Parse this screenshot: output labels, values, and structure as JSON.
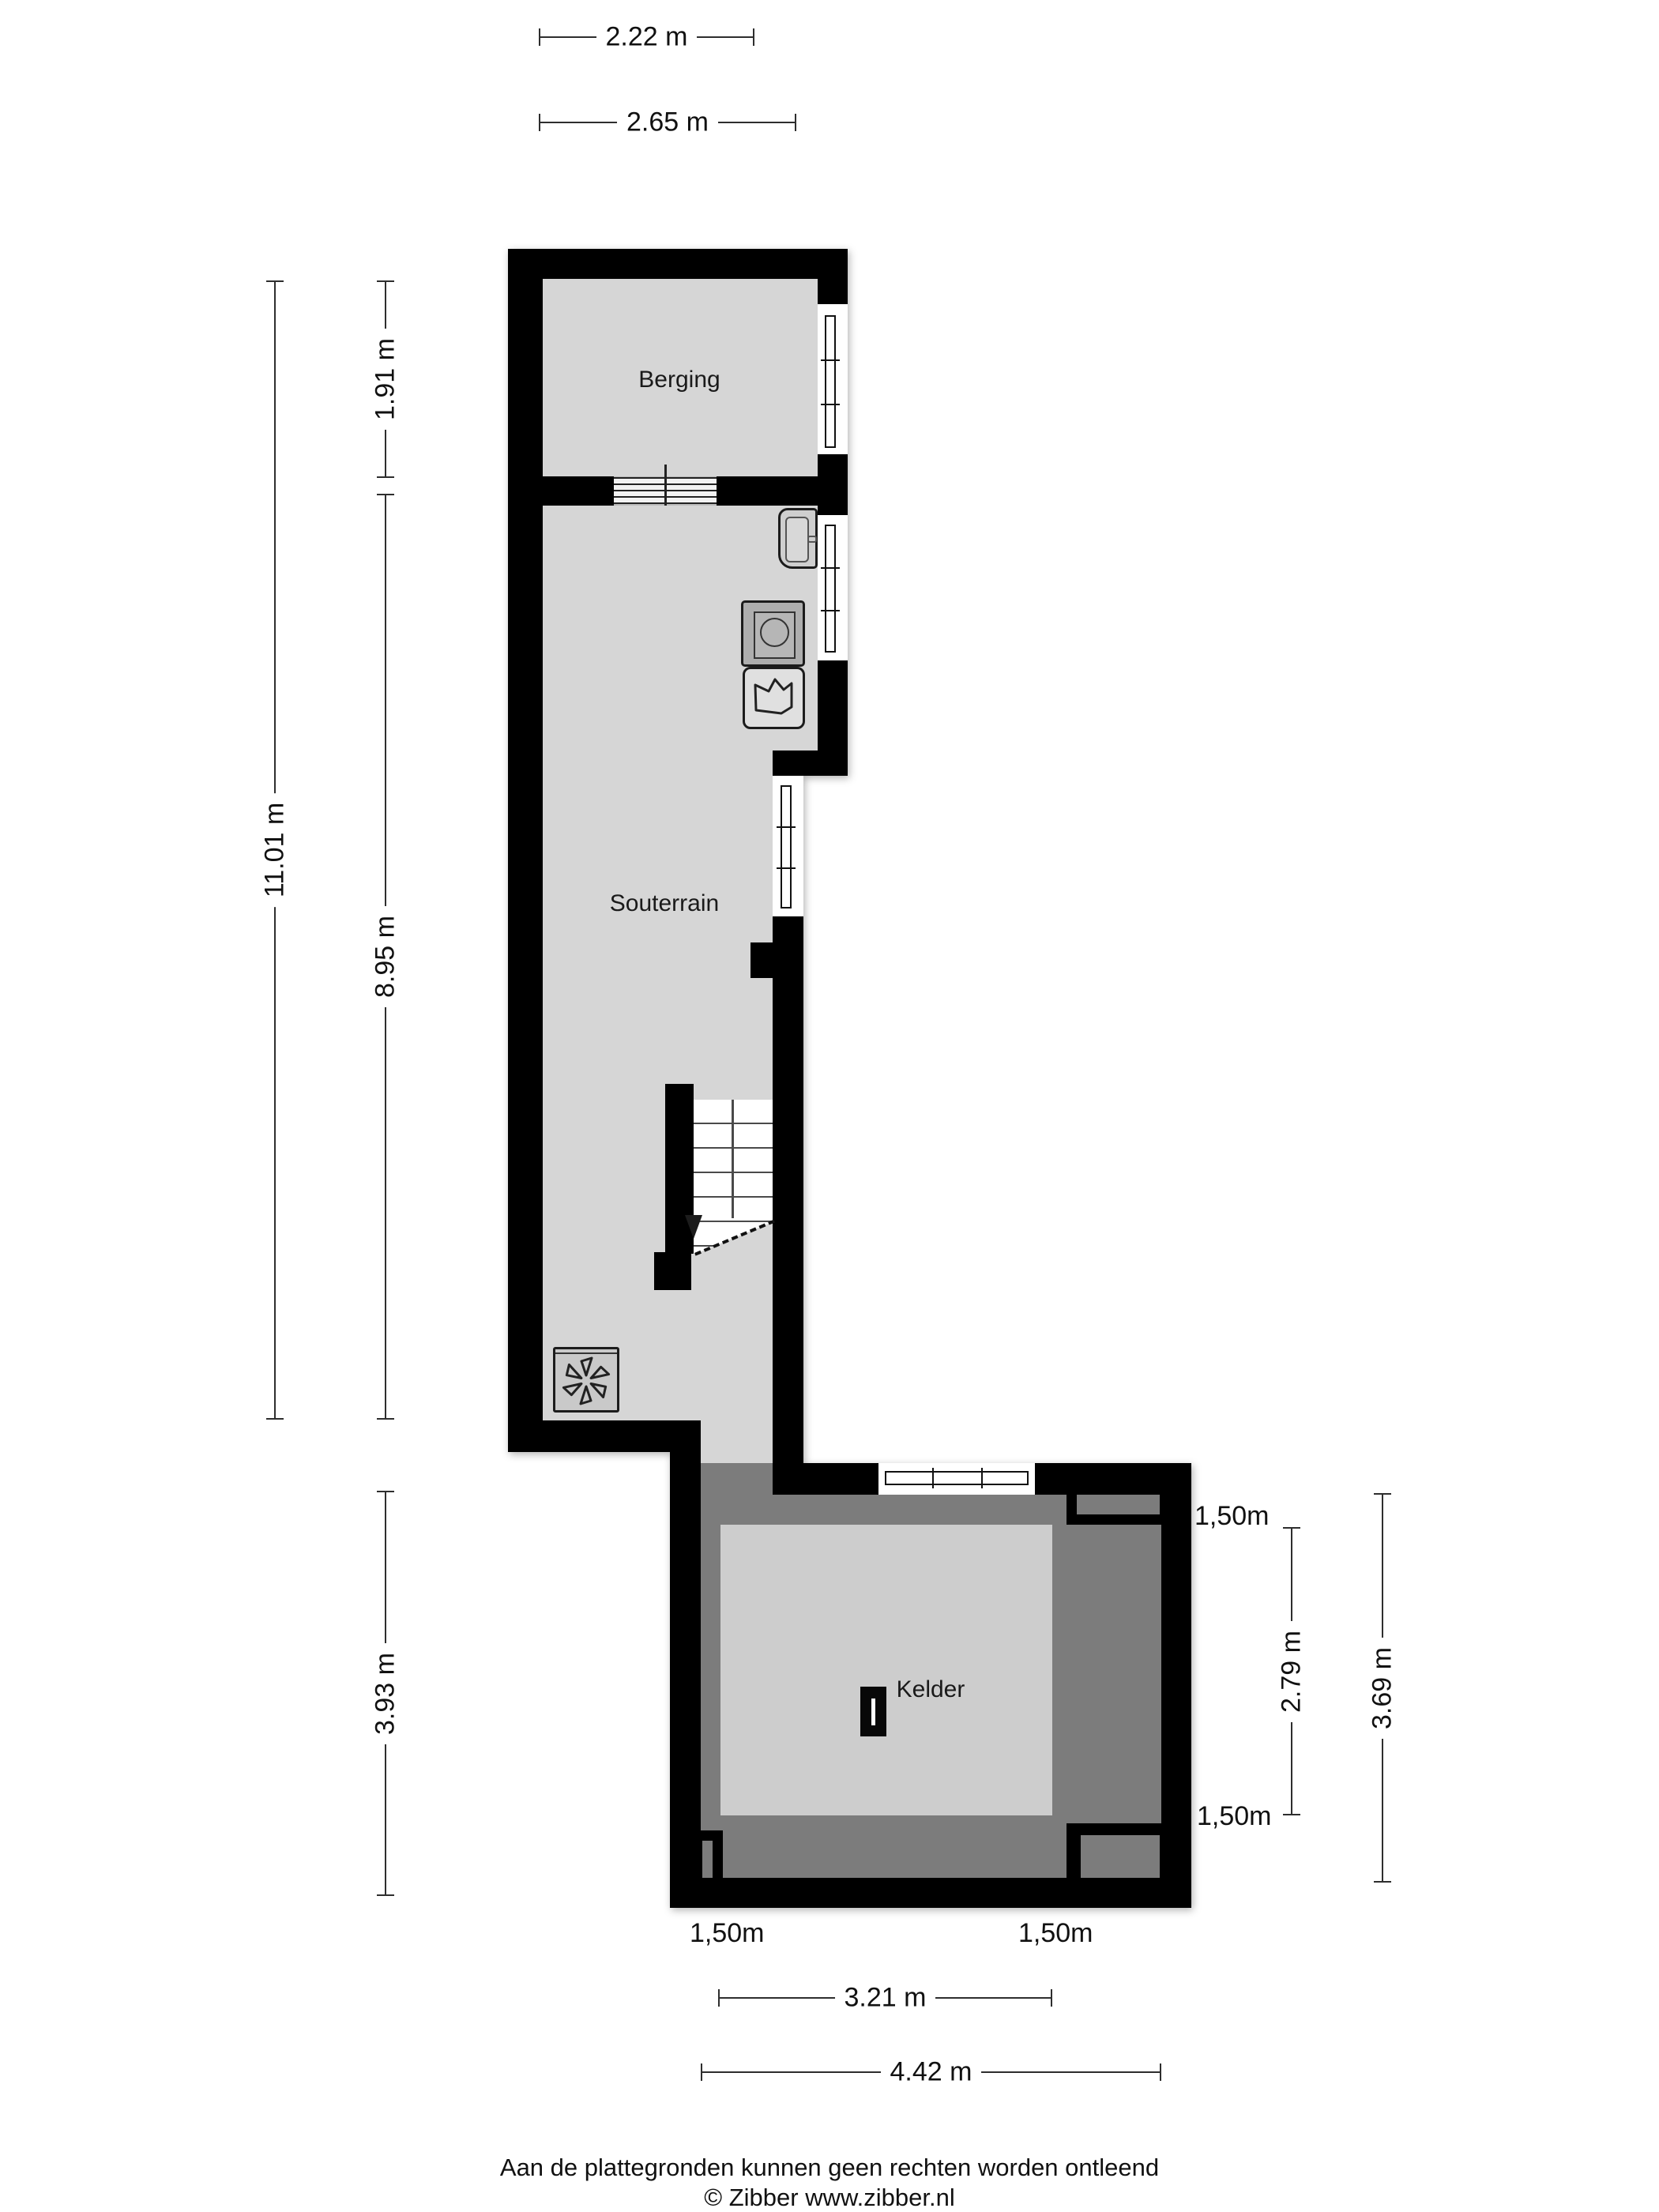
{
  "colors": {
    "wall": "#000000",
    "floor_souterrain": "#d6d6d6",
    "floor_kelder_inner": "#cdcdcd",
    "low_headroom_zone": "#7c7c7c",
    "window": "#ffffff"
  },
  "rooms": {
    "berging": {
      "label": "Berging"
    },
    "souterrain": {
      "label": "Souterrain"
    },
    "kelder": {
      "label": "Kelder"
    }
  },
  "dimensions": {
    "top": [
      {
        "label": "2.22 m"
      },
      {
        "label": "2.65 m"
      }
    ],
    "left": [
      {
        "label": "11.01 m"
      },
      {
        "label": "1.91 m"
      },
      {
        "label": "8.95 m"
      },
      {
        "label": "3.93 m"
      }
    ],
    "right": [
      {
        "label": "2.79 m"
      },
      {
        "label": "3.69 m"
      }
    ],
    "bottom": [
      {
        "label": "3.21 m"
      },
      {
        "label": "4.42 m"
      }
    ],
    "headroom": [
      {
        "label": "1,50m"
      },
      {
        "label": "1,50m"
      },
      {
        "label": "1,50m"
      },
      {
        "label": "1,50m"
      }
    ]
  },
  "icons": {
    "fan": "ventilation-fan",
    "sink": "sink",
    "washing_machine": "washing-machine",
    "laundry_basket": "laundry-basket",
    "stairs": "stairs-down",
    "kelder_door": "door"
  },
  "footer": {
    "line1": "Aan de plattegronden kunnen geen rechten worden ontleend",
    "line2": "© Zibber www.zibber.nl"
  }
}
